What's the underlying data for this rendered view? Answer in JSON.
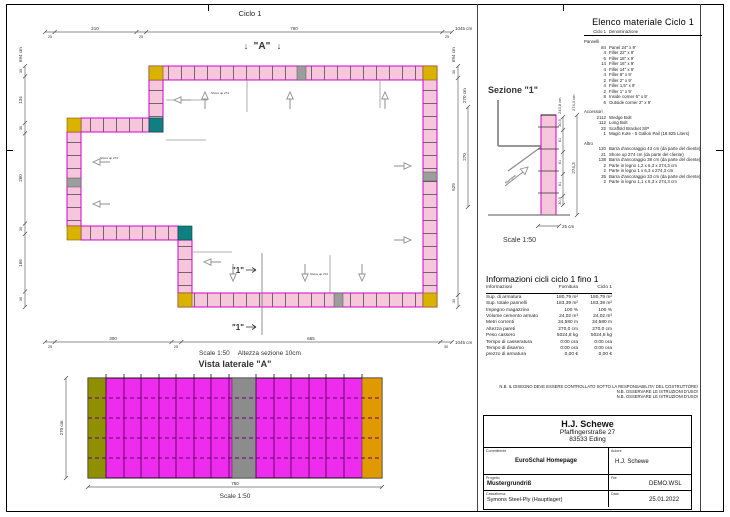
{
  "plan": {
    "title": "Ciclo 1",
    "marker_a": "\"A\"",
    "arrow_down": "↓",
    "marker_1": "\"1\"",
    "dims_top": {
      "segs": [
        "25",
        "210",
        "25",
        "760",
        "25"
      ],
      "total": "1045 cm"
    },
    "dims_bottom": {
      "segs": [
        "25",
        "300",
        "25",
        "665",
        "30"
      ],
      "total": "1045 cm"
    },
    "dims_left": {
      "segs": [
        "30",
        "134",
        "30",
        "260",
        "30",
        "166",
        "30"
      ],
      "total": "694 cm"
    },
    "dims_right": {
      "segs": [
        "30",
        "629",
        "30"
      ],
      "total": "694 cm",
      "inner": "270",
      "inner_label": "270 cm"
    },
    "scale": "Scale 1:50",
    "height_note": "Altezza sezione 10cm",
    "shore_label": "Shore up 274"
  },
  "lateral": {
    "title": "Vista laterale \"A\"",
    "width": "760",
    "height": "270 cm",
    "scale": "Scale 1:50"
  },
  "section": {
    "title": "Sezione \"1\"",
    "chain": [
      "30,5",
      "61",
      "61",
      "61",
      "30,5"
    ],
    "chain_total": "243,8 cm",
    "overall": "274,3",
    "overall_label": "274,3 cm",
    "width": "25 cm",
    "arrow_label": "Riempire",
    "scale": "Scale 1:50"
  },
  "material_list": {
    "title": "Elenco materiale  Ciclo 1",
    "col_qty": "Ciclo 1",
    "col_name": "Denominazione",
    "groups": [
      {
        "name": "Pannelli",
        "items": [
          [
            "84",
            "Panel 24\" x 9'"
          ],
          [
            "4",
            "Filler 22\" x 9'"
          ],
          [
            "6",
            "Filler 18\" x 9'"
          ],
          [
            "14",
            "Filler 16\" x 9'"
          ],
          [
            "4",
            "Filler 14\" x 9'"
          ],
          [
            "4",
            "Filler 8\" x 9'"
          ],
          [
            "2",
            "Filler 2\" x 9'"
          ],
          [
            "4",
            "Filler 1,5\" x 9'"
          ],
          [
            "2",
            "Filler 1\" x 9'"
          ],
          [
            "8",
            "Inside corner 6\" x 9'"
          ],
          [
            "6",
            "Outside corner 2\" x 9'"
          ]
        ]
      },
      {
        "name": "Accessori",
        "items": [
          [
            "2112",
            "Wedge Bolt"
          ],
          [
            "112",
            "Long Bolt"
          ],
          [
            "22",
            "Scaffold Bracket S/P"
          ],
          [
            "1",
            "Magic Kote - 5 Gallon Pail (18.925 Liters)"
          ]
        ]
      },
      {
        "name": "Altro",
        "items": [
          [
            "120",
            "Barra d'ancoraggio 43 cm (da parte del cliente)"
          ],
          [
            "21",
            "Shore up 274 cm (da parte del cliente)"
          ],
          [
            "138",
            "Barra d'ancoraggio 38 cm (da parte del cliente)"
          ],
          [
            "2",
            "Parte in legno 1,2 x 6,3 x 274,3 cm"
          ],
          [
            "2",
            "Parte in legno 1 x 6,3 x 274,3 cm"
          ],
          [
            "35",
            "Barra d'ancoraggio 33 cm (da parte del cliente)"
          ],
          [
            "2",
            "Parte in legno 1,1 x 6,3 x 274,3 cm"
          ]
        ]
      }
    ]
  },
  "cycle_info": {
    "title": "Informazioni cicli  ciclo 1 fino 1",
    "col_info": "Informazioni",
    "col_forn": "Fornitura",
    "col_ciclo": "Ciclo 1",
    "rows": [
      [
        "Sup. di armatura",
        "180,79 m²",
        "180,79 m²"
      ],
      [
        "Sup. totale pannelli",
        "183,39 m²",
        "183,39 m²"
      ],
      [
        "Impegno magazzino",
        "100 %",
        "100 %"
      ],
      [
        "Volume cemento armato",
        "24,02 m³",
        "24,02 m³"
      ],
      [
        "Metri correnti",
        "34,580 m",
        "34,580 m"
      ],
      [
        "Altezza pareti",
        "270,0 cm",
        "270,0 cm"
      ],
      [
        "Peso cassero",
        "5024,8 kg",
        "5024,8 kg"
      ],
      [
        "Tempo di casseratura",
        "0:00 ora",
        "0:00 ora"
      ],
      [
        "Tempo di disarmo",
        "0:00 ora",
        "0:00 ora"
      ],
      [
        "prezzo di armatura",
        "0,00 €",
        "0,00 €"
      ]
    ]
  },
  "notes": [
    "N.B. IL DISEGNO DEVE ESSERE CONTROLLATO SOTTO LA RESPONSABILITA' DEL COSTRUTTORE!",
    "N.B. OSSERVARE LE ISTRUZIONI D'USO!",
    "N.B. OSSERVARE LE ISTRUZIONI D'USO!"
  ],
  "title_block": {
    "company": "H.J. Schewe",
    "street": "Pfaffingerstraße 27",
    "city": "83533 Eding",
    "labels": {
      "committente": "Committente",
      "autore": "Autore",
      "progetto": "Progetto",
      "file": "File",
      "cassaforma": "Cassaforma",
      "data": "Data"
    },
    "values": {
      "committente": "EuroSchal Homepage",
      "autore": "H.J. Schewe",
      "progetto": "Mustergrundriß",
      "file": "DEMO.WSL",
      "cassaforma": "Symons Steel-Ply (Hauptlager)",
      "data": "25.01.2022"
    }
  },
  "colors": {
    "panel_pink": "#f6c6da",
    "panel_magenta": "#ee2cee",
    "joint_magenta": "#d400d4",
    "corner_yellow": "#d9b300",
    "inside_corner_teal": "#0f7f7f",
    "filler_gray": "#9d9d9d"
  }
}
